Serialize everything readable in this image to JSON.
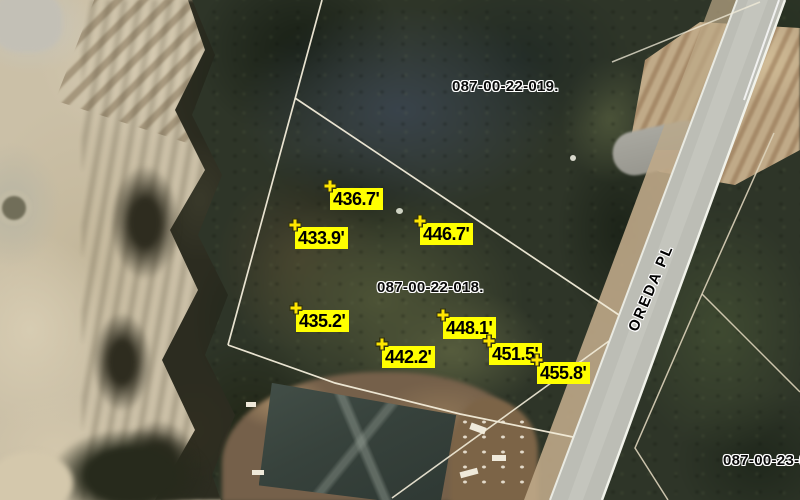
{
  "map": {
    "road_label": "OREDA PL",
    "parcel_labels": [
      {
        "text": "087-00-22-019."
      },
      {
        "text": "087-00-22-018."
      },
      {
        "text": "087-00-23-00"
      }
    ],
    "elevation_labels": [
      {
        "text": "436.7'"
      },
      {
        "text": "433.9'"
      },
      {
        "text": "446.7'"
      },
      {
        "text": "435.2'"
      },
      {
        "text": "442.2'"
      },
      {
        "text": "448.1'"
      },
      {
        "text": "451.5'"
      },
      {
        "text": "455.8'"
      }
    ],
    "colors": {
      "elevation_label_bg": "#ffff00",
      "elevation_label_text": "#000000",
      "parcel_line": "#f3edda",
      "road_surface": "#bcbdb5"
    }
  }
}
